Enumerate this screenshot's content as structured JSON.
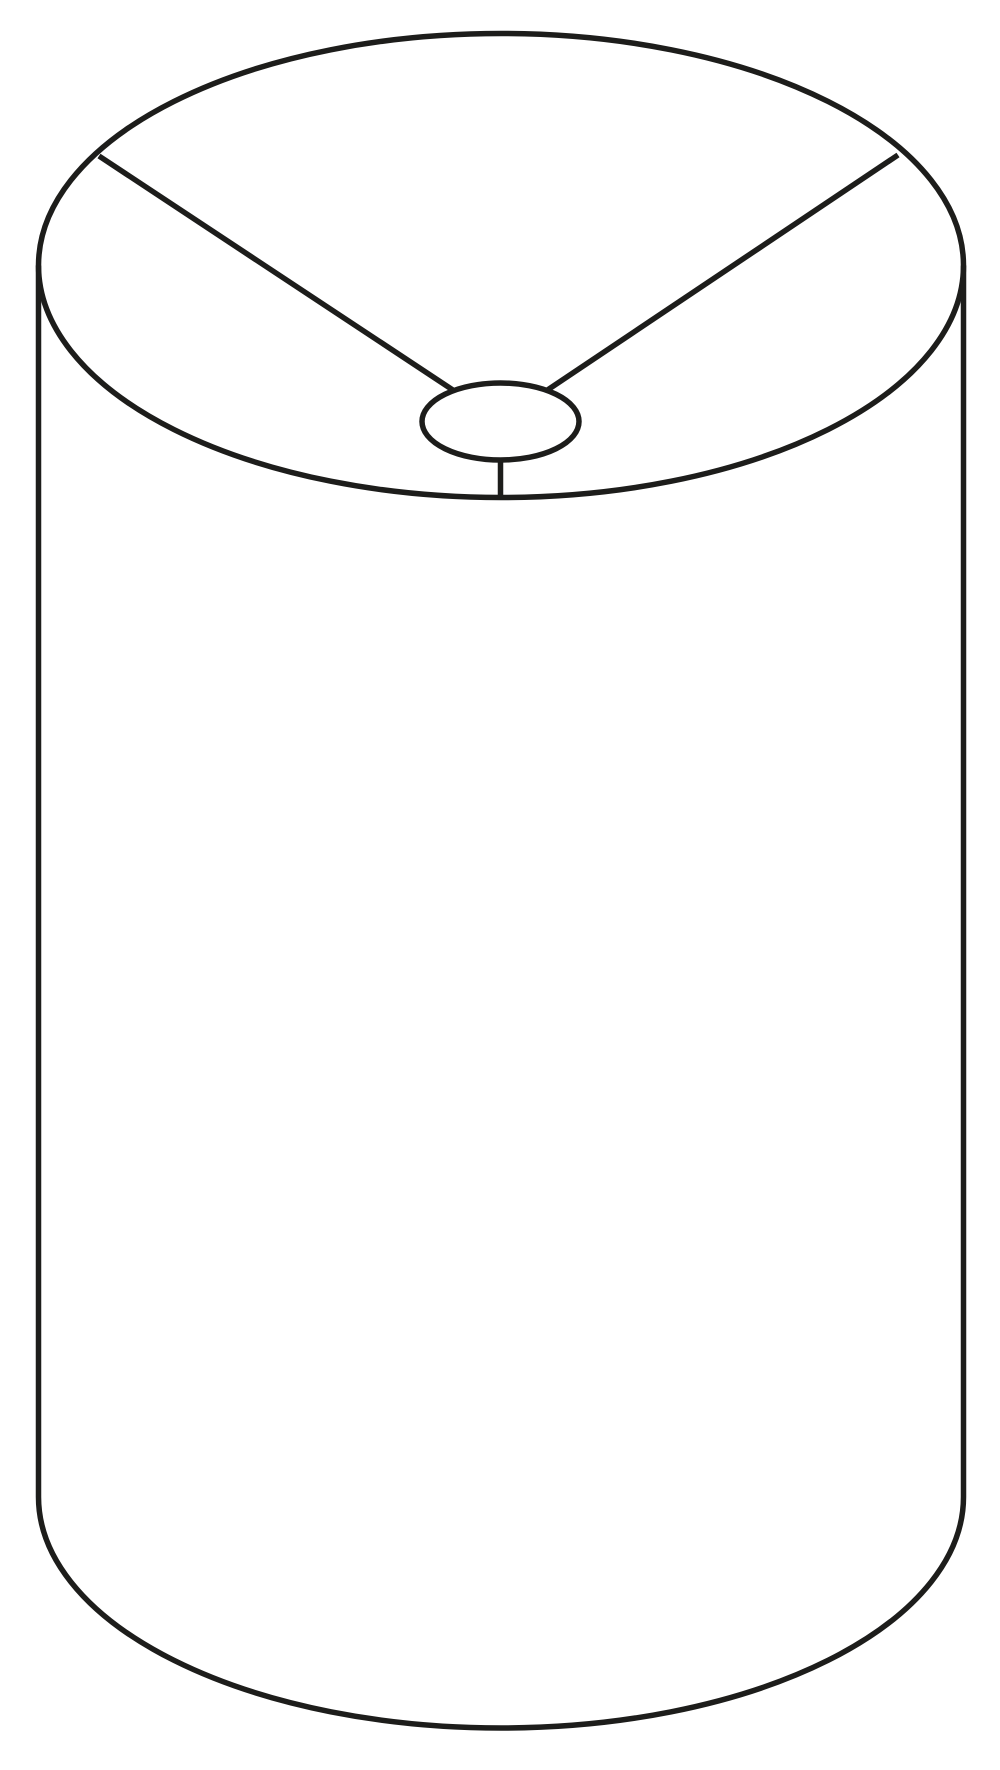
{
  "figure": {
    "title": "drum-lampshade-line-drawing",
    "background_color": "#ffffff",
    "line_color": "#1d1d1b",
    "line_width": 5.5,
    "canvas": {
      "width": 1000,
      "height": 1770
    },
    "shapes": [
      {
        "name": "top-rim-ellipse",
        "type": "ellipse",
        "cx": 501,
        "cy": 265.5,
        "rx": 462.5,
        "ry": 232,
        "fill": "none"
      },
      {
        "name": "spider-spoke-left",
        "type": "line",
        "x1": 99,
        "y1": 156,
        "x2": 500.5,
        "y2": 421.5
      },
      {
        "name": "spider-spoke-right",
        "type": "line",
        "x1": 898,
        "y1": 155,
        "x2": 500.5,
        "y2": 421.5
      },
      {
        "name": "spider-spoke-front",
        "type": "line",
        "x1": 500.5,
        "y1": 421.5,
        "x2": 500.5,
        "y2": 497.5
      },
      {
        "name": "fitter-ring",
        "type": "ellipse",
        "cx": 500.5,
        "cy": 421.5,
        "rx": 78.5,
        "ry": 38.5,
        "fill": "#ffffff"
      },
      {
        "name": "side-left",
        "type": "line",
        "x1": 38.5,
        "y1": 265.5,
        "x2": 38.5,
        "y2": 1497
      },
      {
        "name": "side-right",
        "type": "line",
        "x1": 963.5,
        "y1": 265.5,
        "x2": 963.5,
        "y2": 1497
      },
      {
        "name": "bottom-rim-arc",
        "type": "path",
        "d": "M 38.5 1497 A 462.5 231 0 0 0 963.5 1497",
        "fill": "none"
      }
    ]
  }
}
